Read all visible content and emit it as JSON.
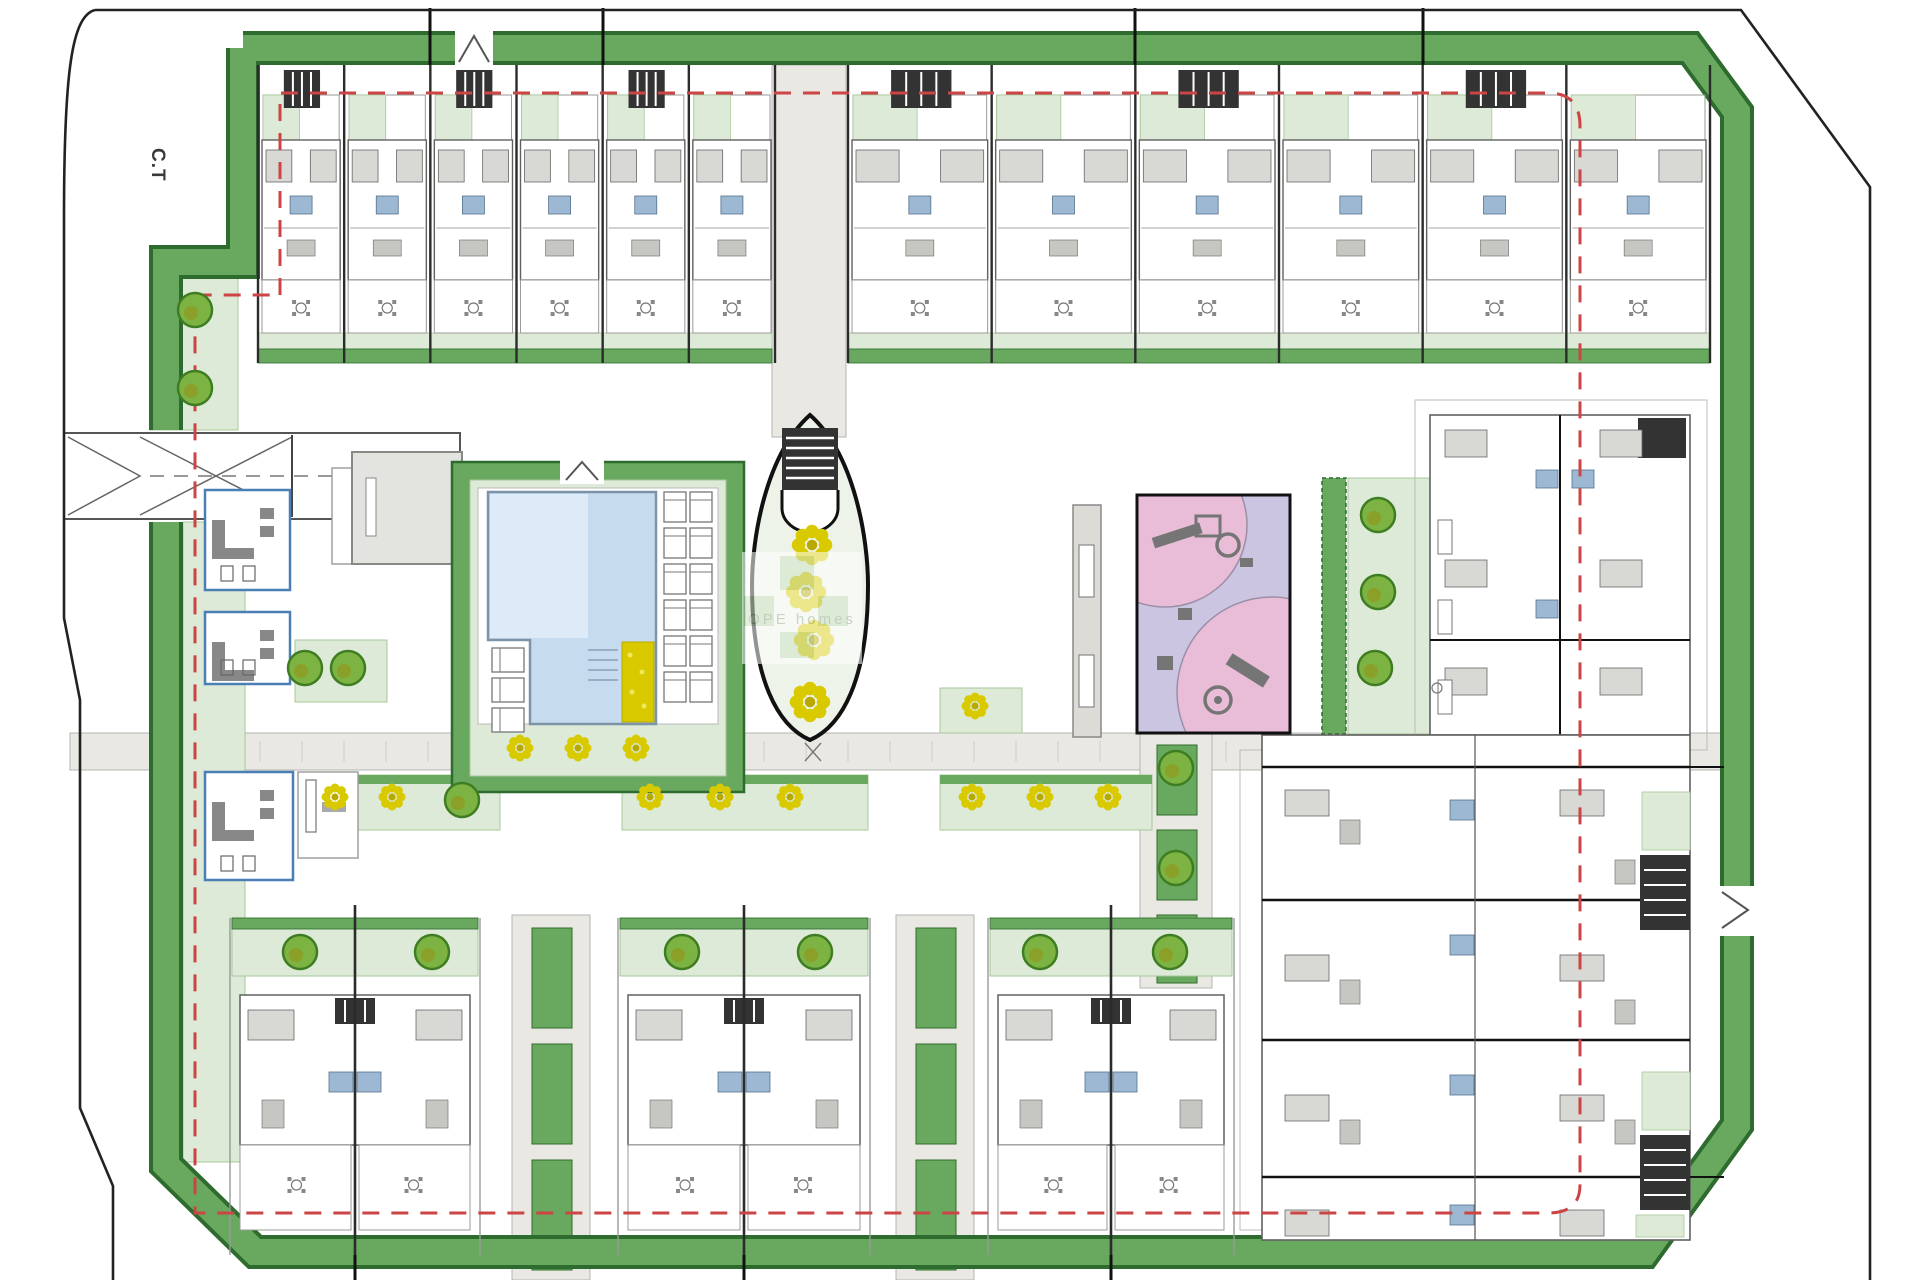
{
  "labels": {
    "transformer": "C.T"
  },
  "watermark": {
    "text": "OPE homes"
  },
  "colors": {
    "paper": "#ffffff",
    "boundary": "#222222",
    "band_green": "#69a95f",
    "band_dark": "#2e6b2e",
    "lawn_light": "#dcead7",
    "lawn_edge": "#a9c89b",
    "setback_red": "#cc4444",
    "path_gray": "#e9e8e3",
    "path_edge": "#b5b5b0",
    "wall_dark": "#2b2b2b",
    "wall_gray": "#606060",
    "furniture_gray": "#c6c6c2",
    "bed_gray": "#d8d8d4",
    "pool_blue": "#c6dbee",
    "pool_blue_light": "#dcebf7",
    "pool_edge": "#7d93a8",
    "bath_blue": "#9db8d2",
    "playground_pink": "#e9bdd8",
    "playground_path": "#ccc5e2",
    "equipment_gray": "#757575",
    "tree_green": "#7cb342",
    "tree_dark": "#3f7d23",
    "flower_yellow": "#d9ca00",
    "flower_dark": "#b8a800",
    "room_blue": "#4a7fb5",
    "building_gray": "#e3e3df",
    "stair_dark": "#333333"
  },
  "site": {
    "top_row": {
      "left_units": 6,
      "right_units": 6
    },
    "bottom_duplex_buildings": 3,
    "right_block_levels": 4,
    "pool": {
      "lounger_rows_right": 6,
      "lounger_columns_right": 2,
      "loungers_left": 3
    },
    "trees": [
      [
        195,
        310
      ],
      [
        195,
        388
      ],
      [
        305,
        668
      ],
      [
        348,
        668
      ],
      [
        462,
        800
      ],
      [
        1176,
        768
      ],
      [
        1176,
        868
      ],
      [
        300,
        952
      ],
      [
        432,
        952
      ],
      [
        682,
        952
      ],
      [
        815,
        952
      ],
      [
        1040,
        952
      ],
      [
        1170,
        952
      ],
      [
        1378,
        515
      ],
      [
        1378,
        592
      ],
      [
        1375,
        668
      ]
    ],
    "flowers": [
      [
        520,
        748
      ],
      [
        578,
        748
      ],
      [
        636,
        748
      ],
      [
        335,
        797
      ],
      [
        392,
        797
      ],
      [
        650,
        797
      ],
      [
        720,
        797
      ],
      [
        790,
        797
      ],
      [
        972,
        797
      ],
      [
        1040,
        797
      ],
      [
        1108,
        797
      ],
      [
        975,
        706
      ]
    ],
    "oval_bushes": [
      [
        812,
        545
      ],
      [
        806,
        592
      ],
      [
        814,
        640
      ],
      [
        810,
        702
      ]
    ]
  }
}
